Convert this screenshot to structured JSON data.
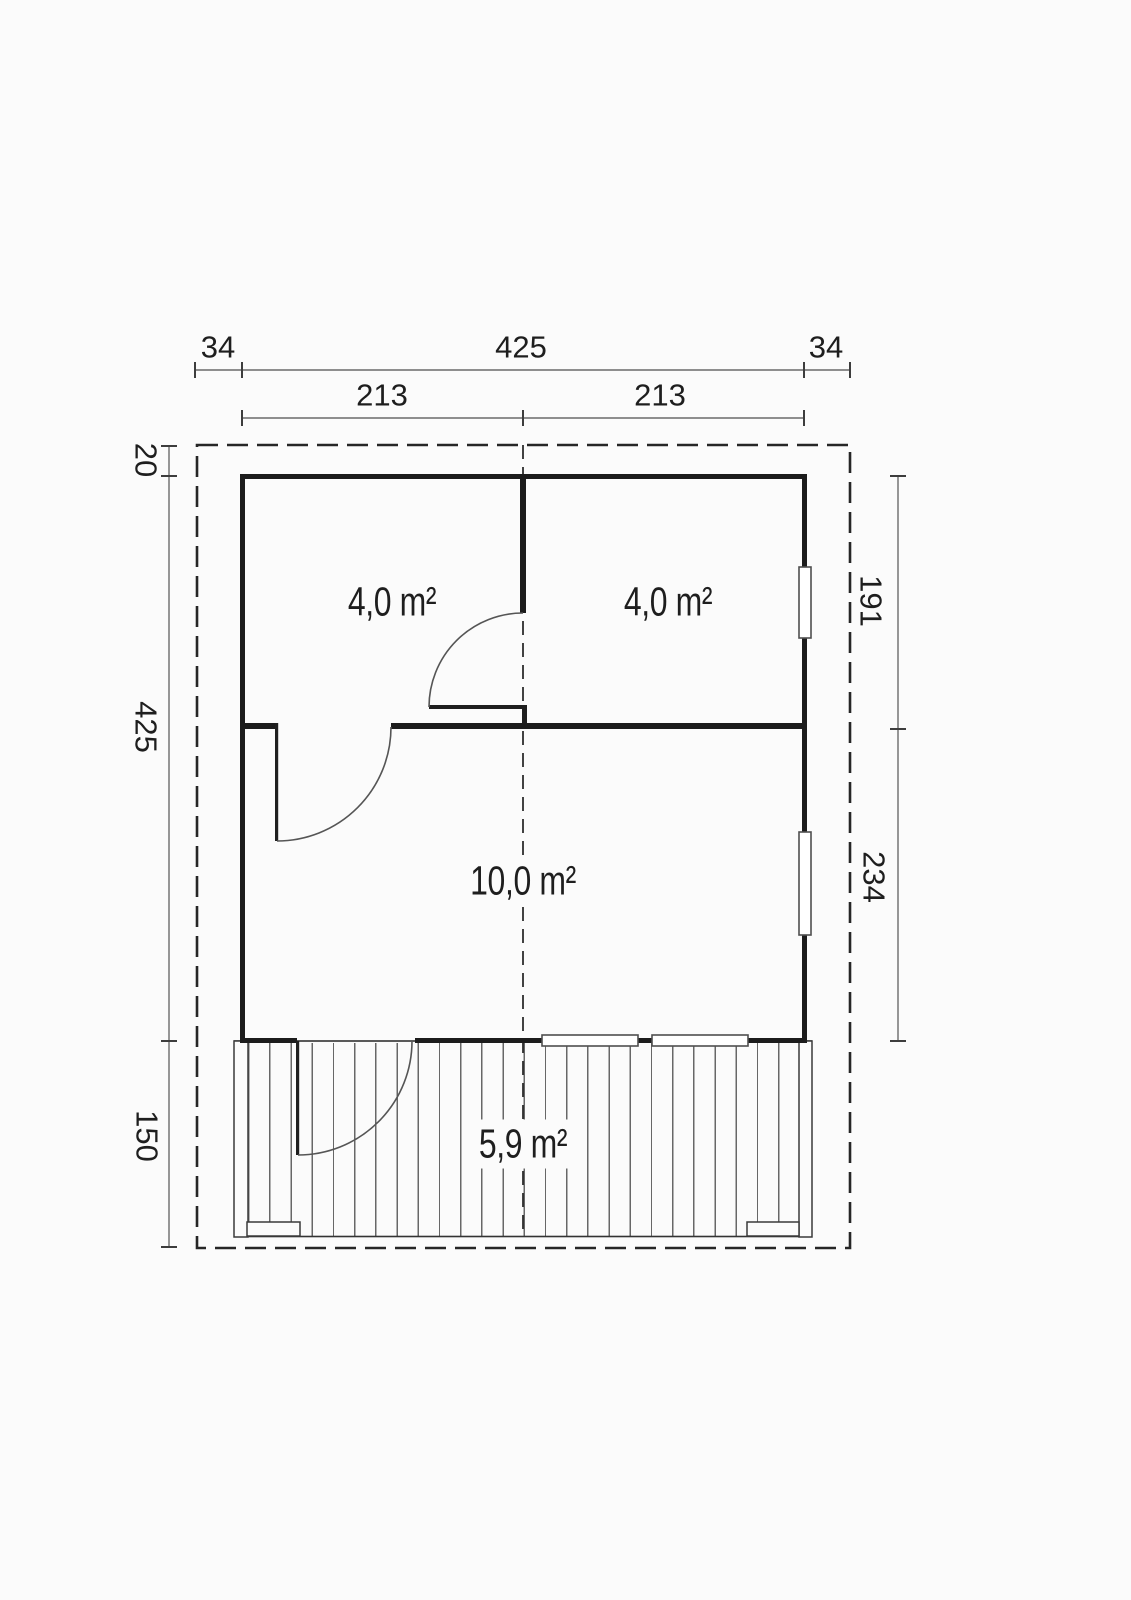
{
  "plan_type": "floor-plan",
  "dimensions": {
    "top_outer": {
      "left": "34",
      "middle": "425",
      "right": "34"
    },
    "top_inner": {
      "left": "213",
      "right": "213"
    },
    "left_side": {
      "top": "20",
      "middle": "425",
      "bottom": "150"
    },
    "right_side": {
      "top": "191",
      "bottom": "234"
    }
  },
  "rooms": {
    "top_left": {
      "area_label": "4,0 m²"
    },
    "top_right": {
      "area_label": "4,0 m²"
    },
    "main": {
      "area_label": "10,0 m²"
    },
    "terrace": {
      "area_label": "5,9 m²"
    }
  },
  "colors": {
    "wall": "#1c1c1c",
    "thin_line": "#3c3c3c",
    "dim_line": "#6b6b6b",
    "text": "#1e1e1e",
    "background": "#fbfbfb"
  }
}
